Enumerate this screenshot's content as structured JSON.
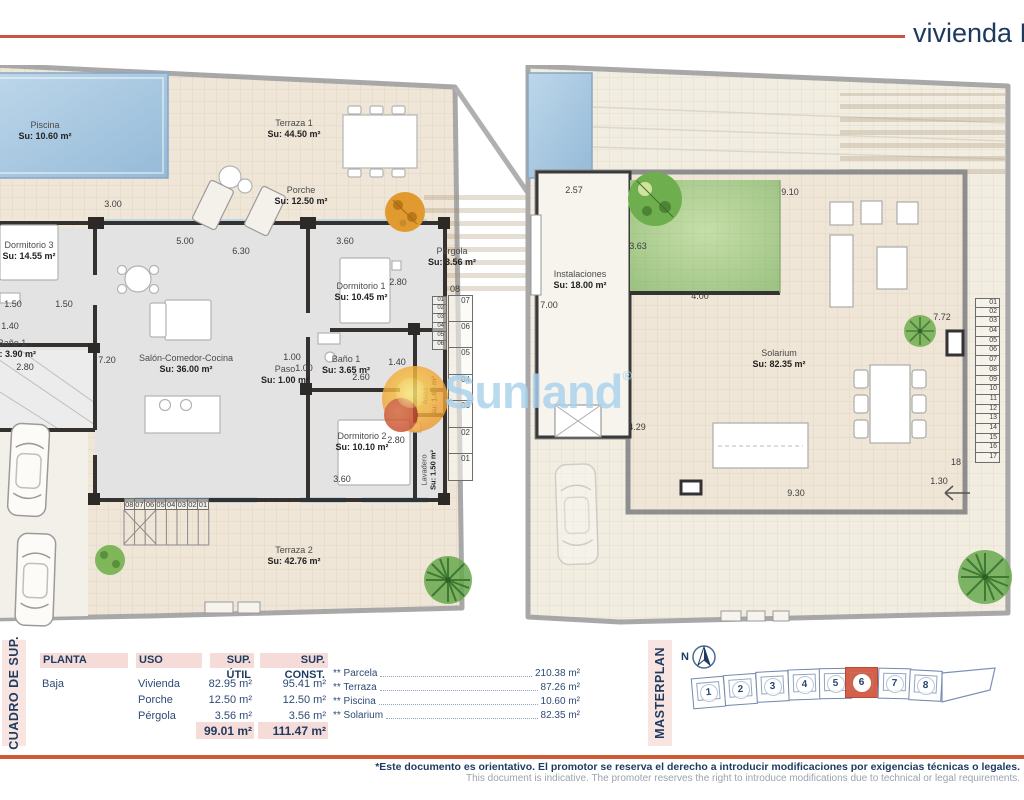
{
  "header": {
    "title": "vivienda N"
  },
  "watermark": {
    "text": "Sunland",
    "reg": "®"
  },
  "plans": {
    "left": {
      "rooms": [
        {
          "name": "Piscina",
          "area": "Su: 10.60 m²"
        },
        {
          "name": "Terraza 1",
          "area": "Su: 44.50 m²"
        },
        {
          "name": "Porche",
          "area": "Su: 12.50 m²"
        },
        {
          "name": "Pérgola",
          "area": "Su: 3.56 m²"
        },
        {
          "name": "Dormitorio 3",
          "area": "Su: 14.55 m²"
        },
        {
          "name": "Baño 1",
          "area": "Su: 3.90 m²"
        },
        {
          "name": "Salón-Comedor-Cocina",
          "area": "Su: 36.00 m²"
        },
        {
          "name": "Dormitorio 1",
          "area": "Su: 10.45 m²"
        },
        {
          "name": "Paso",
          "area": "Su: 1.00 m²"
        },
        {
          "name": "Baño 1",
          "area": "Su: 3.65 m²"
        },
        {
          "name": "Dormitorio 2",
          "area": "Su: 10.10 m²"
        },
        {
          "name": "Terraza 2",
          "area": "Su: 42.76 m²"
        },
        {
          "name": "Aseo",
          "area": "Su: 1.60 m²"
        },
        {
          "name": "Lavadero",
          "area": "Su: 1.50 m²"
        }
      ],
      "dims": [
        "3.00",
        "6.30",
        "5.00",
        "3.60",
        "2.80",
        "1.50",
        "1.50",
        "1.40",
        "2.80",
        "7.20",
        "1.00",
        "1.00",
        "1.40",
        "2.60",
        "2.80",
        "3.60"
      ],
      "stair_side_top": "08",
      "stair_side": [
        "07",
        "06",
        "05",
        "04",
        "03",
        "02",
        "01"
      ],
      "stair_inner": [
        "01",
        "02",
        "03",
        "04",
        "05",
        "06"
      ],
      "stair_bottom": [
        "08",
        "07",
        "06",
        "05",
        "04",
        "03",
        "02",
        "01"
      ]
    },
    "right": {
      "rooms": [
        {
          "name": "Instalaciones",
          "area": "Su: 18.00 m²"
        },
        {
          "name": "Solarium",
          "area": "Su: 82.35 m²"
        }
      ],
      "dims": [
        "2.57",
        "9.10",
        "3.63",
        "4.00",
        "7.00",
        "7.72",
        "4.29",
        "9.30",
        "1.30",
        "18"
      ],
      "stair": [
        "01",
        "02",
        "03",
        "04",
        "05",
        "06",
        "07",
        "08",
        "09",
        "10",
        "11",
        "12",
        "13",
        "14",
        "15",
        "16",
        "17"
      ]
    }
  },
  "cuadro": {
    "strip_label": "CUADRO DE SUP.",
    "headers": [
      "PLANTA",
      "USO",
      "SUP. ÚTIL",
      "SUP. CONST."
    ],
    "planta": "Baja",
    "rows": [
      {
        "uso": "Vivienda",
        "util": "82.95 m²",
        "const": "95.41 m²"
      },
      {
        "uso": "Porche",
        "util": "12.50 m²",
        "const": "12.50 m²"
      },
      {
        "uso": "Pérgola",
        "util": "3.56 m²",
        "const": "3.56 m²"
      }
    ],
    "total_util": "99.01 m²",
    "total_const": "111.47 m²"
  },
  "extras": [
    {
      "label": "** Parcela",
      "value": "210.38 m²"
    },
    {
      "label": "** Terraza",
      "value": "87.26 m²"
    },
    {
      "label": "** Piscina",
      "value": "10.60 m²"
    },
    {
      "label": "** Solarium",
      "value": "82.35 m²"
    }
  ],
  "masterplan": {
    "strip_label": "MASTERPLAN",
    "north": "N",
    "units": [
      "1",
      "2",
      "3",
      "4",
      "5",
      "6",
      "7",
      "8"
    ],
    "highlighted_unit": "6"
  },
  "footer": {
    "line1": "*Este documento es orientativo. El promotor se reserva el derecho a introducir modificaciones por exigencias técnicas o legales.",
    "line2": "This document is indicative. The promoter reserves the right to introduce modifications due to technical or legal requirements."
  }
}
